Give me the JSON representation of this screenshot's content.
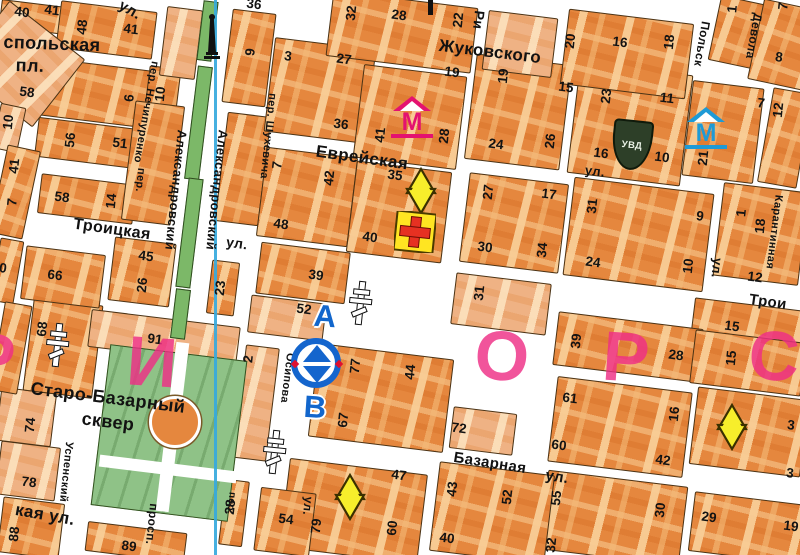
{
  "meta": {
    "description": "Scanned city street map fragment (Odessa centre), Cyrillic labels",
    "numbers_format": "[house_number, x, y, orientation h|v]",
    "streets_format": "[text, x, y, rotation_deg, font_px]",
    "blocks_format": "[cx, cy, w, h, rotation_deg, type b|l|m|p|w|d]"
  },
  "colors": {
    "block_orange": "#e5873e",
    "block_light": "#efb284",
    "block_outline": "#4b3315",
    "park_green": "#8fc287",
    "median_green": "#7cb868",
    "street_white": "#ffffff",
    "route_blue": "#36a9dd",
    "metro_magenta": "#e41270",
    "metro_blue": "#1e9ad6",
    "star_yellow": "#f7ee2b",
    "cross_red": "#e63122",
    "cross_bg_yellow": "#ffe522",
    "uvd_green": "#2d3f28",
    "district_pink": "#ef2f86",
    "marker_blue": "#1465cd",
    "label_black": "#121212"
  },
  "streets": [
    [
      "ул.",
      130,
      10,
      30,
      15
    ],
    [
      "спольская",
      52,
      44,
      2,
      18
    ],
    [
      "пл.",
      30,
      66,
      2,
      18
    ],
    [
      "пер. Нечипуренко",
      146,
      112,
      100,
      11
    ],
    [
      "Александровский",
      176,
      190,
      96,
      13
    ],
    [
      "Александровский",
      217,
      190,
      96,
      13
    ],
    [
      "пер.",
      140,
      180,
      96,
      11
    ],
    [
      "Жуковского",
      490,
      52,
      7,
      17
    ],
    [
      "Еврейская",
      362,
      158,
      8,
      17
    ],
    [
      "Троицкая",
      112,
      230,
      8,
      16
    ],
    [
      "ул.",
      237,
      243,
      8,
      14
    ],
    [
      "Трои",
      768,
      302,
      8,
      15
    ],
    [
      "Базарная",
      490,
      463,
      9,
      15
    ],
    [
      "ул.",
      557,
      477,
      9,
      15
    ],
    [
      "кая ул.",
      45,
      515,
      10,
      17
    ],
    [
      "Успенский",
      66,
      472,
      96,
      11
    ],
    [
      "просп.",
      152,
      524,
      96,
      12
    ],
    [
      "пер.",
      231,
      503,
      96,
      10
    ],
    [
      "Осипова",
      287,
      378,
      97,
      11
    ],
    [
      "пер. Шухевича",
      268,
      136,
      96,
      11
    ],
    [
      "Ри",
      479,
      20,
      96,
      14
    ],
    [
      "Польск",
      702,
      44,
      100,
      12
    ],
    [
      "Девола",
      754,
      36,
      100,
      12
    ],
    [
      "Карантинная",
      774,
      232,
      97,
      11
    ],
    [
      "ул.",
      595,
      171,
      7,
      13
    ],
    [
      "ул.",
      717,
      268,
      96,
      13
    ],
    [
      "ул.",
      308,
      506,
      96,
      12
    ],
    [
      "Старо-Базарный",
      108,
      398,
      7,
      18
    ],
    [
      "сквер",
      108,
      422,
      7,
      18
    ]
  ],
  "numbers": [
    [
      40,
      22,
      12,
      "h"
    ],
    [
      41,
      52,
      10,
      "h"
    ],
    [
      48,
      82,
      27,
      "v"
    ],
    [
      41,
      131,
      29,
      "h"
    ],
    [
      58,
      27,
      92,
      "h"
    ],
    [
      6,
      129,
      98,
      "v"
    ],
    [
      10,
      8,
      122,
      "v"
    ],
    [
      56,
      70,
      140,
      "v"
    ],
    [
      51,
      120,
      143,
      "h"
    ],
    [
      10,
      160,
      94,
      "v"
    ],
    [
      41,
      14,
      166,
      "v"
    ],
    [
      7,
      12,
      202,
      "v"
    ],
    [
      58,
      62,
      197,
      "h"
    ],
    [
      14,
      111,
      201,
      "v"
    ],
    [
      9,
      250,
      52,
      "v"
    ],
    [
      36,
      254,
      4,
      "h"
    ],
    [
      3,
      288,
      56,
      "h"
    ],
    [
      27,
      344,
      59,
      "h"
    ],
    [
      36,
      341,
      124,
      "h"
    ],
    [
      32,
      351,
      13,
      "v"
    ],
    [
      28,
      399,
      15,
      "h"
    ],
    [
      22,
      458,
      20,
      "v"
    ],
    [
      19,
      452,
      72,
      "h"
    ],
    [
      19,
      503,
      76,
      "v"
    ],
    [
      20,
      570,
      41,
      "v"
    ],
    [
      16,
      620,
      42,
      "h"
    ],
    [
      18,
      669,
      42,
      "v"
    ],
    [
      1,
      732,
      9,
      "v"
    ],
    [
      7,
      783,
      6,
      "v"
    ],
    [
      8,
      779,
      57,
      "h"
    ],
    [
      15,
      566,
      87,
      "h"
    ],
    [
      23,
      606,
      96,
      "v"
    ],
    [
      11,
      667,
      98,
      "h"
    ],
    [
      7,
      761,
      103,
      "h"
    ],
    [
      12,
      778,
      110,
      "v"
    ],
    [
      16,
      601,
      153,
      "h"
    ],
    [
      10,
      662,
      157,
      "h"
    ],
    [
      21,
      703,
      158,
      "v"
    ],
    [
      41,
      380,
      135,
      "v"
    ],
    [
      28,
      444,
      136,
      "v"
    ],
    [
      42,
      329,
      178,
      "v"
    ],
    [
      35,
      395,
      175,
      "h"
    ],
    [
      7,
      277,
      165,
      "v"
    ],
    [
      48,
      281,
      224,
      "h"
    ],
    [
      40,
      370,
      237,
      "h"
    ],
    [
      27,
      488,
      192,
      "v"
    ],
    [
      17,
      549,
      194,
      "h"
    ],
    [
      30,
      485,
      247,
      "h"
    ],
    [
      34,
      542,
      250,
      "v"
    ],
    [
      24,
      496,
      144,
      "h"
    ],
    [
      26,
      550,
      141,
      "v"
    ],
    [
      31,
      592,
      206,
      "v"
    ],
    [
      9,
      700,
      216,
      "h"
    ],
    [
      24,
      593,
      262,
      "h"
    ],
    [
      10,
      688,
      266,
      "v"
    ],
    [
      1,
      741,
      213,
      "v"
    ],
    [
      18,
      760,
      226,
      "v"
    ],
    [
      12,
      755,
      277,
      "h"
    ],
    [
      66,
      55,
      275,
      "h"
    ],
    [
      26,
      142,
      285,
      "v"
    ],
    [
      45,
      146,
      256,
      "h"
    ],
    [
      23,
      220,
      288,
      "v"
    ],
    [
      39,
      316,
      275,
      "h"
    ],
    [
      31,
      479,
      293,
      "v"
    ],
    [
      15,
      732,
      326,
      "h"
    ],
    [
      52,
      304,
      309,
      "h"
    ],
    [
      68,
      42,
      329,
      "v"
    ],
    [
      91,
      155,
      339,
      "h"
    ],
    [
      74,
      30,
      425,
      "v"
    ],
    [
      2,
      248,
      359,
      "v"
    ],
    [
      77,
      355,
      366,
      "v"
    ],
    [
      44,
      410,
      372,
      "v"
    ],
    [
      67,
      343,
      420,
      "v"
    ],
    [
      72,
      459,
      428,
      "h"
    ],
    [
      39,
      576,
      341,
      "v"
    ],
    [
      28,
      676,
      355,
      "h"
    ],
    [
      15,
      731,
      358,
      "v"
    ],
    [
      61,
      570,
      398,
      "h"
    ],
    [
      16,
      674,
      414,
      "v"
    ],
    [
      60,
      559,
      445,
      "h"
    ],
    [
      42,
      663,
      460,
      "h"
    ],
    [
      3,
      791,
      425,
      "h"
    ],
    [
      3,
      790,
      473,
      "h"
    ],
    [
      78,
      29,
      482,
      "h"
    ],
    [
      88,
      14,
      534,
      "v"
    ],
    [
      89,
      129,
      546,
      "h"
    ],
    [
      28,
      230,
      507,
      "v"
    ],
    [
      54,
      286,
      519,
      "h"
    ],
    [
      79,
      316,
      526,
      "v"
    ],
    [
      60,
      392,
      528,
      "v"
    ],
    [
      47,
      399,
      475,
      "h"
    ],
    [
      43,
      452,
      489,
      "v"
    ],
    [
      52,
      507,
      497,
      "v"
    ],
    [
      40,
      447,
      538,
      "h"
    ],
    [
      55,
      556,
      498,
      "v"
    ],
    [
      30,
      660,
      510,
      "v"
    ],
    [
      32,
      551,
      545,
      "v"
    ],
    [
      29,
      709,
      517,
      "h"
    ],
    [
      19,
      791,
      526,
      "h"
    ],
    [
      0,
      3,
      268,
      "h"
    ]
  ],
  "district_letters": [
    [
      "Р",
      -8,
      358
    ],
    [
      "И",
      152,
      362
    ],
    [
      "О",
      502,
      356
    ],
    [
      "Р",
      626,
      357
    ],
    [
      "С",
      774,
      356
    ]
  ],
  "icons": {
    "metro_letter": "М",
    "metro": [
      {
        "x": 412,
        "y": 120,
        "color": "#e41270"
      },
      {
        "x": 706,
        "y": 131,
        "color": "#1e9ad6"
      }
    ],
    "stars": [
      {
        "x": 421,
        "y": 191
      },
      {
        "x": 350,
        "y": 497
      },
      {
        "x": 732,
        "y": 427
      }
    ],
    "red_cross": {
      "x": 415,
      "y": 232
    },
    "church_crosses": [
      {
        "x": 57,
        "y": 345
      },
      {
        "x": 360,
        "y": 303
      },
      {
        "x": 274,
        "y": 452
      }
    ],
    "pole_fragment": {
      "x": 428,
      "y": 0
    },
    "uvd": {
      "x": 630,
      "y": 143,
      "label": "УВД"
    },
    "monument": {
      "x": 212,
      "y": 38
    },
    "interchange": {
      "x": 317,
      "y": 364,
      "letter_top": "А",
      "letter_bottom": "В",
      "top_xy": [
        325,
        316
      ],
      "bottom_xy": [
        315,
        407
      ]
    },
    "route_line_x": 214
  },
  "blocks": [
    [
      32,
      16,
      64,
      26,
      7,
      "b"
    ],
    [
      105,
      29,
      95,
      46,
      7,
      "b"
    ],
    [
      78,
      90,
      138,
      56,
      7,
      "b"
    ],
    [
      95,
      143,
      118,
      38,
      7,
      "b"
    ],
    [
      161,
      96,
      30,
      58,
      7,
      "b"
    ],
    [
      180,
      42,
      34,
      68,
      7,
      "l"
    ],
    [
      248,
      57,
      42,
      92,
      7,
      "b"
    ],
    [
      242,
      168,
      42,
      108,
      7,
      "b"
    ],
    [
      319,
      89,
      100,
      93,
      7,
      "b"
    ],
    [
      306,
      196,
      90,
      88,
      7,
      "b"
    ],
    [
      302,
      272,
      88,
      50,
      7,
      "b"
    ],
    [
      286,
      317,
      74,
      36,
      7,
      "l"
    ],
    [
      380,
      397,
      134,
      92,
      7,
      "b"
    ],
    [
      482,
      430,
      62,
      40,
      7,
      "l"
    ],
    [
      398,
      211,
      94,
      90,
      7,
      "b"
    ],
    [
      513,
      222,
      98,
      88,
      7,
      "b"
    ],
    [
      500,
      303,
      94,
      50,
      7,
      "l"
    ],
    [
      637,
      233,
      139,
      97,
      7,
      "b"
    ],
    [
      760,
      233,
      84,
      92,
      7,
      "b"
    ],
    [
      747,
      325,
      110,
      42,
      7,
      "b"
    ],
    [
      517,
      111,
      94,
      104,
      7,
      "b"
    ],
    [
      409,
      116,
      102,
      92,
      7,
      "b"
    ],
    [
      629,
      123,
      112,
      110,
      7,
      "b"
    ],
    [
      722,
      131,
      70,
      94,
      7,
      "b"
    ],
    [
      784,
      137,
      38,
      94,
      10,
      "b"
    ],
    [
      627,
      346,
      144,
      52,
      7,
      "b"
    ],
    [
      619,
      426,
      134,
      84,
      7,
      "b"
    ],
    [
      747,
      362,
      110,
      52,
      7,
      "b"
    ],
    [
      748,
      431,
      110,
      76,
      7,
      "b"
    ],
    [
      612,
      517,
      139,
      78,
      7,
      "b"
    ],
    [
      747,
      527,
      112,
      58,
      7,
      "b"
    ],
    [
      352,
      510,
      137,
      88,
      7,
      "b"
    ],
    [
      491,
      512,
      114,
      88,
      7,
      "b"
    ],
    [
      284,
      521,
      54,
      62,
      7,
      "b"
    ],
    [
      233,
      512,
      22,
      64,
      7,
      "b"
    ],
    [
      401,
      31,
      144,
      64,
      7,
      "b"
    ],
    [
      519,
      43,
      68,
      58,
      7,
      "l"
    ],
    [
      626,
      53,
      124,
      74,
      7,
      "b"
    ],
    [
      735,
      31,
      42,
      64,
      12,
      "b"
    ],
    [
      784,
      44,
      58,
      80,
      12,
      "b"
    ],
    [
      27,
      470,
      58,
      52,
      7,
      "l"
    ],
    [
      25,
      416,
      54,
      52,
      7,
      "l"
    ],
    [
      62,
      347,
      68,
      92,
      7,
      "b"
    ],
    [
      163,
      336,
      148,
      36,
      7,
      "l"
    ],
    [
      62,
      276,
      78,
      52,
      7,
      "b"
    ],
    [
      141,
      271,
      60,
      62,
      7,
      "b"
    ],
    [
      86,
      198,
      94,
      38,
      7,
      "b"
    ],
    [
      222,
      287,
      26,
      52,
      7,
      "b"
    ],
    [
      20,
      63,
      94,
      84,
      38,
      "l"
    ],
    [
      8,
      127,
      24,
      44,
      12,
      "l"
    ],
    [
      14,
      191,
      32,
      88,
      12,
      "b"
    ],
    [
      6,
      270,
      22,
      62,
      10,
      "b"
    ],
    [
      10,
      347,
      26,
      88,
      10,
      "b"
    ],
    [
      152,
      162,
      48,
      118,
      7,
      "b"
    ],
    [
      135,
      541,
      98,
      28,
      7,
      "b"
    ],
    [
      30,
      527,
      60,
      54,
      7,
      "b"
    ],
    [
      255,
      402,
      32,
      112,
      7,
      "l"
    ],
    [
      206,
      30,
      13,
      58,
      7,
      "m"
    ],
    [
      197,
      122,
      13,
      112,
      7,
      "m"
    ],
    [
      188,
      232,
      13,
      108,
      7,
      "m"
    ],
    [
      179,
      313,
      13,
      48,
      7,
      "m"
    ],
    [
      168,
      432,
      136,
      160,
      7,
      "p"
    ],
    [
      172,
      427,
      13,
      170,
      7,
      "w"
    ],
    [
      168,
      469,
      138,
      12,
      7,
      "w"
    ],
    [
      172,
      419,
      46,
      46,
      0,
      "d"
    ]
  ]
}
